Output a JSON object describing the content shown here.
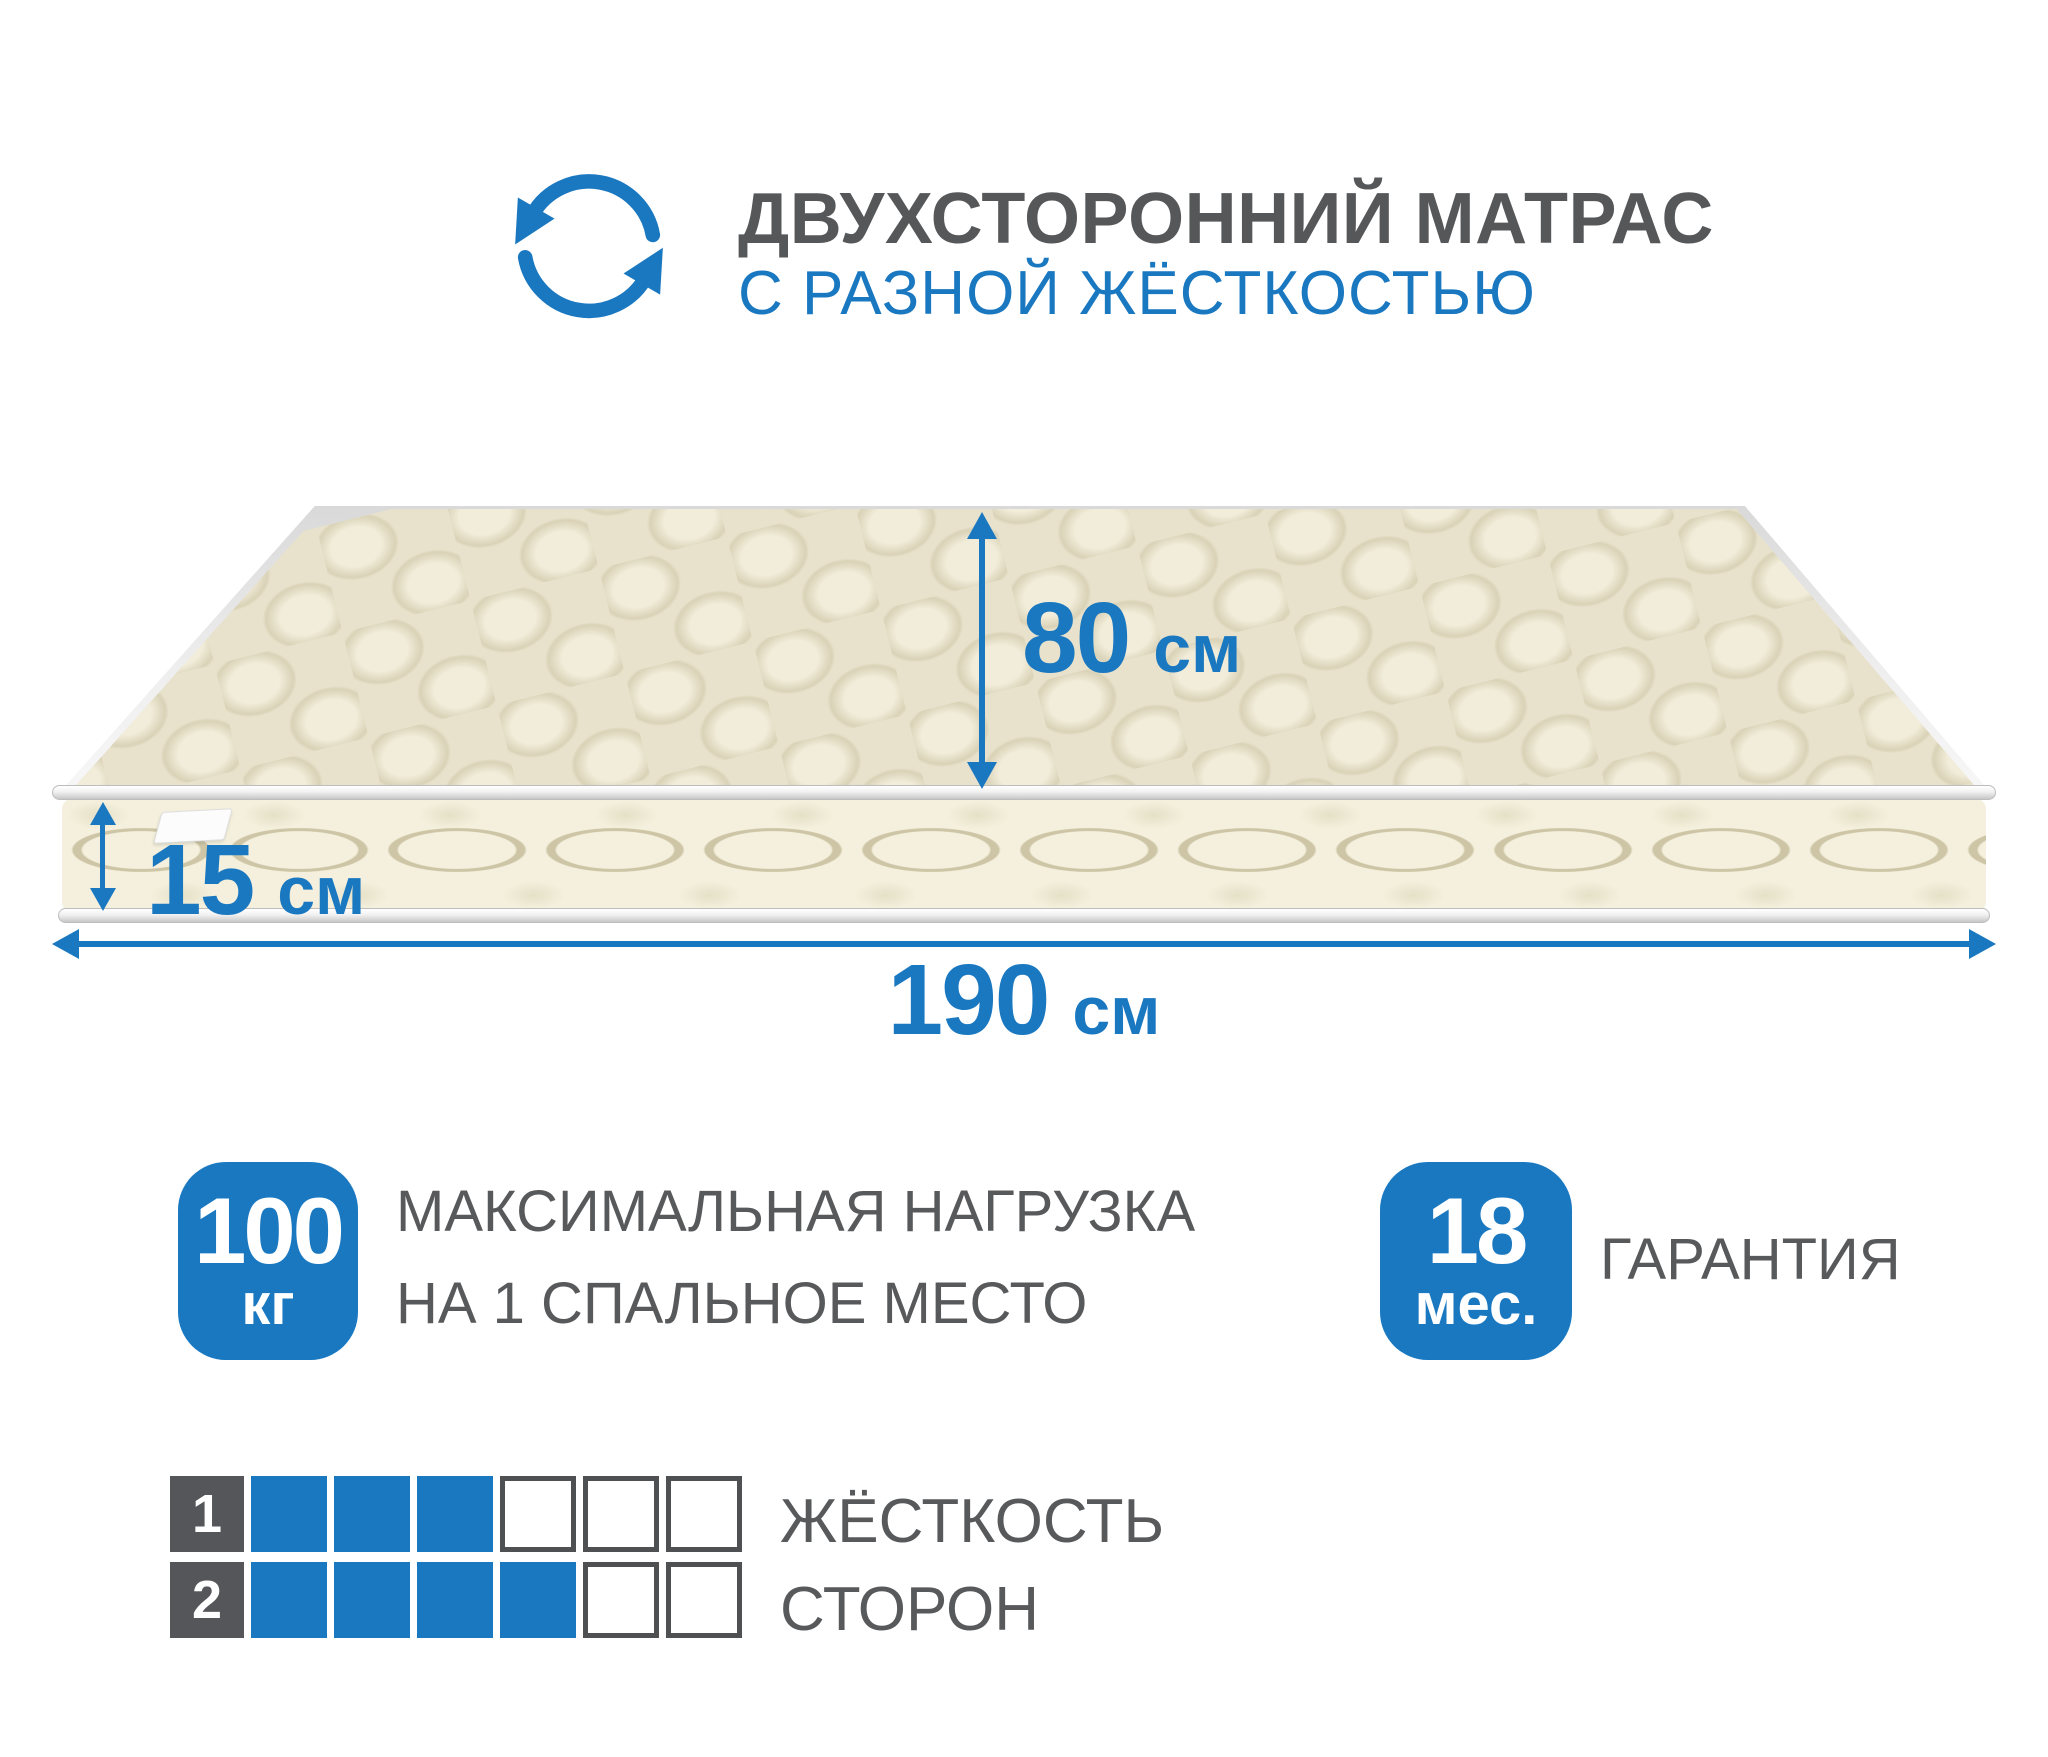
{
  "header": {
    "title": "ДВУХСТОРОННИЙ МАТРАС",
    "subtitle": "С РАЗНОЙ ЖЁСТКОСТЬЮ"
  },
  "dims": {
    "width": {
      "value": "80",
      "unit": "см"
    },
    "height": {
      "value": "15",
      "unit": "см"
    },
    "length": {
      "value": "190",
      "unit": "см"
    }
  },
  "badges": {
    "load": {
      "value": "100",
      "unit": "кг",
      "line1": "МАКСИМАЛЬНАЯ НАГРУЗКА",
      "line2": "НА 1 СПАЛЬНОЕ МЕСТО"
    },
    "warranty": {
      "value": "18",
      "unit": "мес.",
      "label": "ГАРАНТИЯ"
    }
  },
  "firmness": {
    "title_line1": "ЖЁСТКОСТЬ",
    "title_line2": "СТОРОН",
    "scale_max": 6,
    "rows": [
      {
        "number": "1",
        "filled": 3
      },
      {
        "number": "2",
        "filled": 4
      }
    ]
  },
  "colors": {
    "accent_blue": "#1a78c1",
    "text_gray": "#58595b",
    "mattress_top": "#e8e2cc",
    "mattress_side": "#f4f0dd"
  }
}
